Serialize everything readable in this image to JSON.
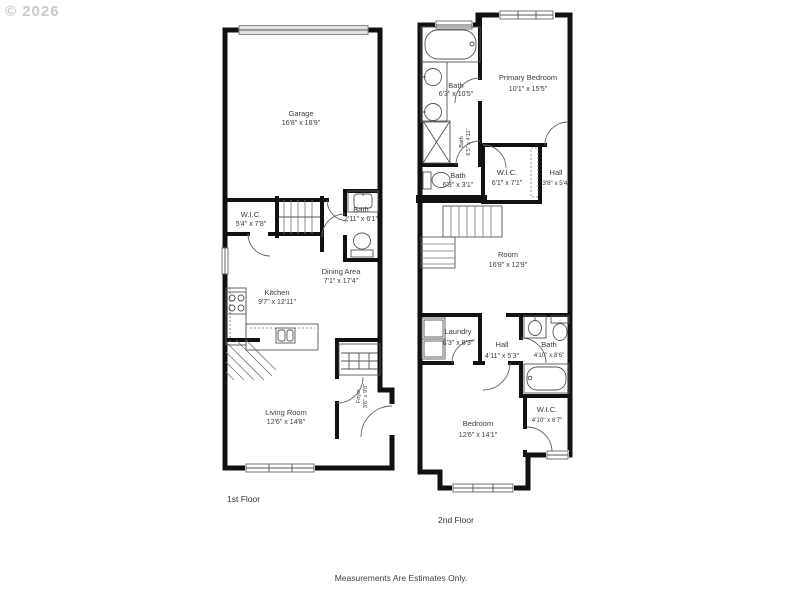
{
  "watermark": "© 2026",
  "footer": {
    "disclaimer": "Measurements Are Estimates Only."
  },
  "floor1": {
    "label": "1st Floor",
    "rooms": {
      "garage": {
        "name": "Garage",
        "dims": "16'8\" x 18'9\""
      },
      "wic": {
        "name": "W.I.C.",
        "dims": "5'4\" x 7'8\""
      },
      "bath": {
        "name": "Bath",
        "dims": "2'11\" x 6'1\""
      },
      "dining": {
        "name": "Dining Area",
        "dims": "7'1\" x 17'4\""
      },
      "kitchen": {
        "name": "Kitchen",
        "dims": "9'7\" x 12'11\""
      },
      "living": {
        "name": "Living Room",
        "dims": "12'6\" x 14'8\""
      },
      "foyer": {
        "name": "Foyer",
        "dims": "3'6\" x 9'6\""
      }
    }
  },
  "floor2": {
    "label": "2nd Floor",
    "rooms": {
      "bath_top": {
        "name": "Bath",
        "dims": "6'3\" x 10'5\""
      },
      "primary_bedroom": {
        "name": "Primary Bedroom",
        "dims": "10'1\" x 15'5\""
      },
      "bath_shower": {
        "name": "Bath",
        "dims": "6'5\" x 4'11\""
      },
      "bath_small": {
        "name": "Bath",
        "dims": "6'3\" x 3'1\""
      },
      "wic_upper": {
        "name": "W.I.C.",
        "dims": "6'1\" x 7'1\""
      },
      "hall_upper": {
        "name": "Hall",
        "dims": "3'8\" x 5'4\""
      },
      "room": {
        "name": "Room",
        "dims": "16'8\" x 12'9\""
      },
      "laundry": {
        "name": "Laundry",
        "dims": "6'3\" x 8'3\""
      },
      "hall_lower": {
        "name": "Hall",
        "dims": "4'11\" x 5'3\""
      },
      "bath_lower": {
        "name": "Bath",
        "dims": "4'10\" x 8'6\""
      },
      "wic_lower": {
        "name": "W.I.C.",
        "dims": "4'10\" x 6'7\""
      },
      "bedroom": {
        "name": "Bedroom",
        "dims": "12'6\" x 14'1\""
      }
    }
  }
}
